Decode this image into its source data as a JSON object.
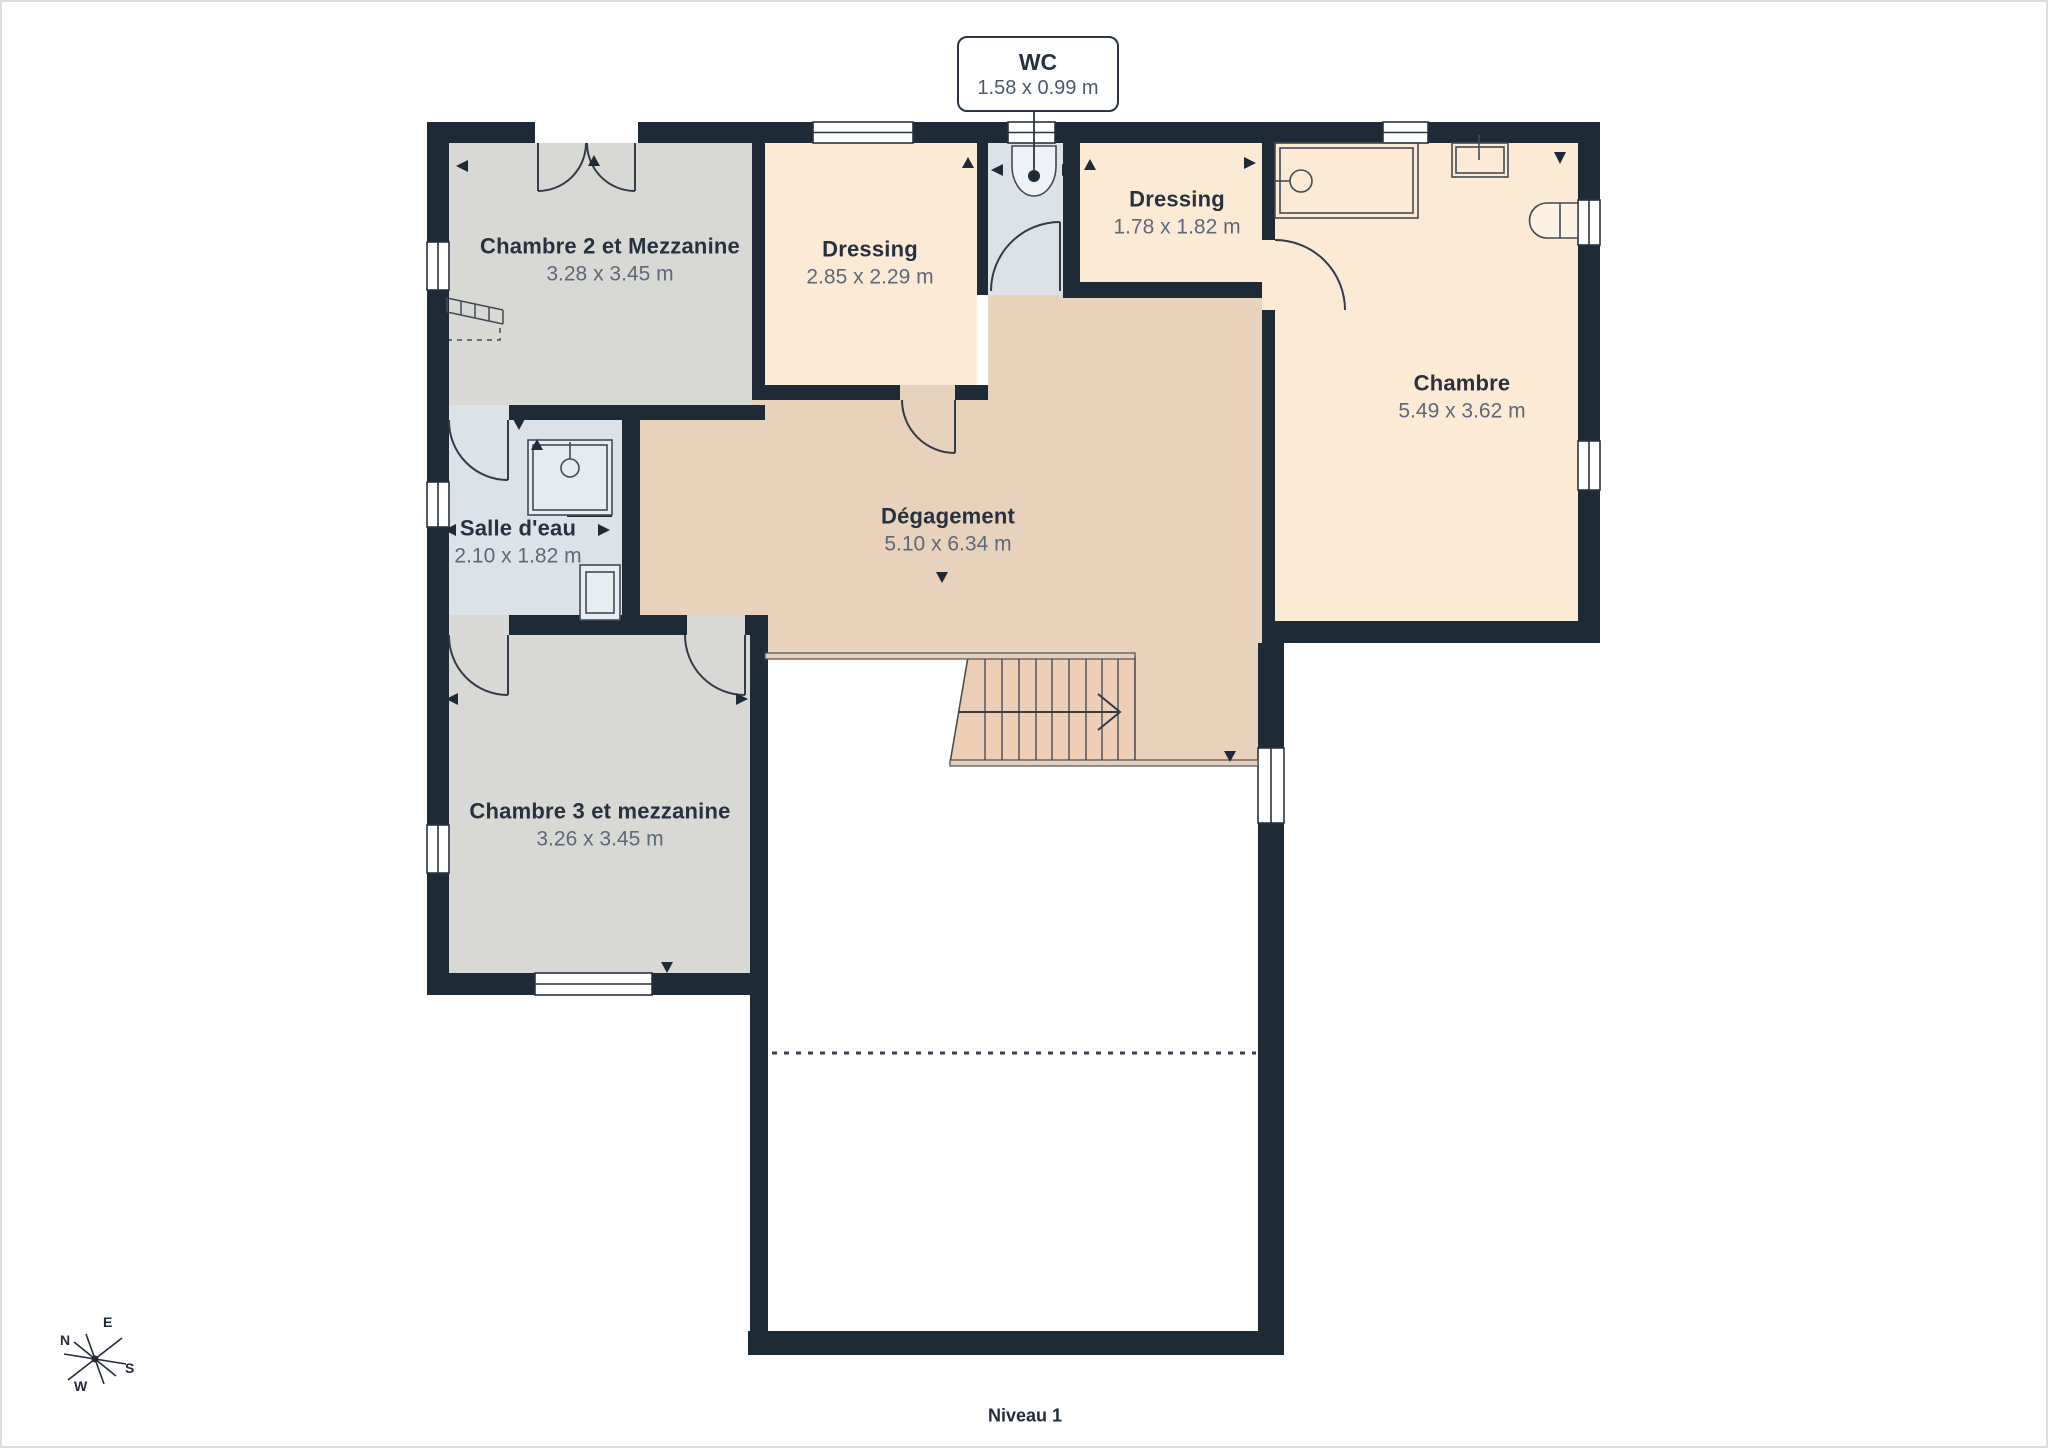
{
  "level_label": "Niveau 1",
  "wc_callout": {
    "name": "WC",
    "dims": "1.58 x 0.99 m"
  },
  "rooms": [
    {
      "id": "chambre-2",
      "name": "Chambre 2 et Mezzanine",
      "dims": "3.28 x 3.45 m"
    },
    {
      "id": "dressing-1",
      "name": "Dressing",
      "dims": "2.85 x 2.29 m"
    },
    {
      "id": "dressing-2",
      "name": "Dressing",
      "dims": "1.78 x 1.82 m"
    },
    {
      "id": "chambre",
      "name": "Chambre",
      "dims": "5.49 x 3.62 m"
    },
    {
      "id": "salle-deau",
      "name": "Salle d'eau",
      "dims": "2.10 x 1.82 m"
    },
    {
      "id": "degagement",
      "name": "Dégagement",
      "dims": "5.10 x 6.34 m"
    },
    {
      "id": "chambre-3",
      "name": "Chambre 3 et mezzanine",
      "dims": "3.26 x 3.45 m"
    }
  ],
  "compass": {
    "north": "N",
    "east": "E",
    "south": "S",
    "west": "W"
  },
  "colors": {
    "wall": "#1f2a37",
    "room_gray": "#d8d8d5",
    "room_peach": "#fcead4",
    "room_tan": "#e9d2bc",
    "room_blue": "#dde2e9",
    "stairs": "#eccfb5",
    "text_dark": "#273140",
    "text_dim": "#5d6878",
    "line": "#39414d"
  }
}
